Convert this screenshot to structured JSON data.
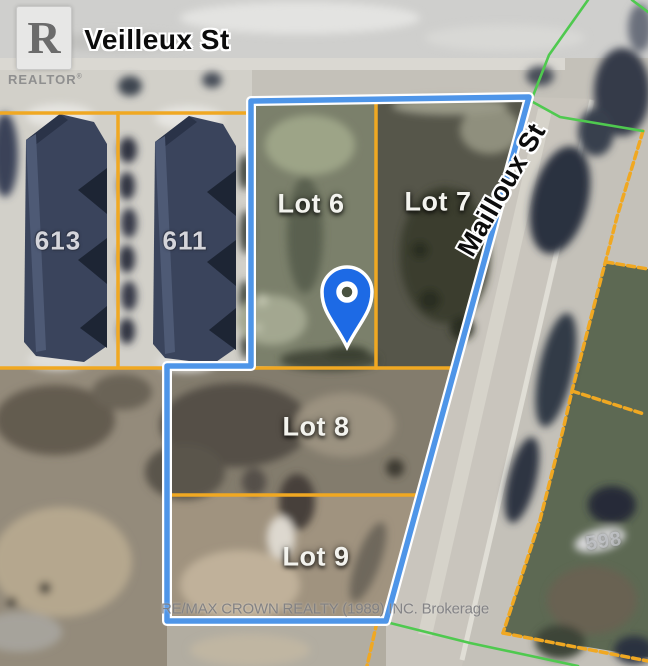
{
  "branding": {
    "realtor_logo": {
      "letter": "R",
      "label": "REALTOR",
      "registered_mark": "®"
    },
    "watermark": "RE/MAX CROWN REALTY (1989) INC. Brokerage"
  },
  "map": {
    "type": "aerial-lot-map",
    "streets": [
      {
        "name": "Veilleux St",
        "orientation": "horizontal-top"
      },
      {
        "name": "Mailloux St",
        "orientation": "diagonal-right"
      }
    ],
    "lots": [
      {
        "label": "Lot 6"
      },
      {
        "label": "Lot 7"
      },
      {
        "label": "Lot 8"
      },
      {
        "label": "Lot 9"
      }
    ],
    "building_numbers": [
      "613",
      "611",
      "598"
    ],
    "marker": {
      "type": "location-pin",
      "color": "#1d6ae5"
    },
    "colors": {
      "boundary_blue": "#4e95e8",
      "boundary_casing": "#ffffff",
      "lot_line_orange": "#f0a822",
      "parcel_line_green": "#4fc94f",
      "pin_blue": "#1d6ae5"
    }
  }
}
